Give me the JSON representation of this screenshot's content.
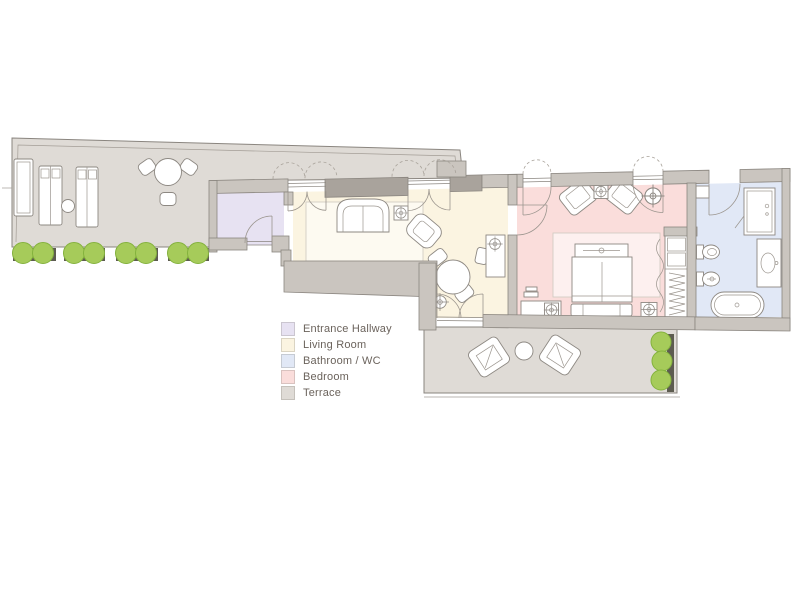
{
  "legend": {
    "items": [
      {
        "label": "Entrance Hallway",
        "color": "#e7e2f2"
      },
      {
        "label": "Living Room",
        "color": "#fbf4e1"
      },
      {
        "label": "Bathroom / WC",
        "color": "#e1e8f6"
      },
      {
        "label": "Bedroom",
        "color": "#fadddb"
      },
      {
        "label": "Terrace",
        "color": "#dfdbd6"
      }
    ]
  },
  "palette": {
    "wall": "#cac5bf",
    "wall_dark": "#a9a39c",
    "outline": "#8a857f",
    "bush": "#a6cb5a",
    "bush_edge": "#84b23d",
    "planter": "#5d5c50",
    "furniture": "#ffffff",
    "label_text": "#6b635c",
    "background": "#ffffff"
  }
}
